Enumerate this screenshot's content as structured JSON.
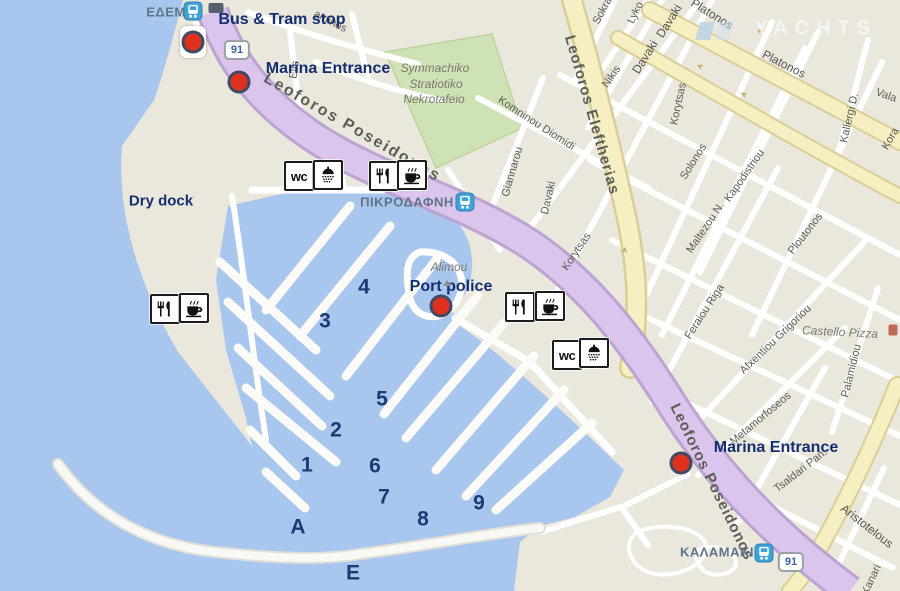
{
  "map": {
    "title": "Alimos marina map",
    "colors": {
      "water": "#A9C6EE",
      "land": "#EAE7DD",
      "green": "#CEE2B6",
      "road_purple": "#DCC5EC",
      "road_purple_edge": "#BCA3D2",
      "road_yellow": "#F5EFC2",
      "road_yellow_edge": "#DCCD96",
      "marker_red": "#E0301E",
      "label_navy": "#152F6E",
      "badge_blue": "#3B5FA8"
    },
    "watermark": {
      "text": "YACHTS"
    },
    "markers": [
      {
        "name": "bus-tram-stop",
        "label": "Bus & Tram stop",
        "label_x": 282,
        "label_y": 20,
        "dot_x": 193,
        "dot_y": 42,
        "white_bg": true
      },
      {
        "name": "marina-entrance-north",
        "label": "Marina Entrance",
        "label_x": 328,
        "label_y": 69,
        "dot_x": 239,
        "dot_y": 82,
        "white_bg": false
      },
      {
        "name": "port-police",
        "label": "Port police",
        "label_x": 451,
        "label_y": 287,
        "dot_x": 441,
        "dot_y": 306,
        "white_bg": false
      },
      {
        "name": "marina-entrance-south",
        "label": "Marina Entrance",
        "label_x": 776,
        "label_y": 448,
        "dot_x": 681,
        "dot_y": 463,
        "white_bg": false
      }
    ],
    "area_labels": [
      {
        "text": "Dry dock",
        "x": 161,
        "y": 201,
        "cls": "drydock"
      }
    ],
    "stations": [
      {
        "text": "ΕΔΕΜ",
        "x": 166,
        "y": 12,
        "icon_x": 193,
        "icon_y": 11
      },
      {
        "text": "ΠΙΚΡΟΔΑΦΝΗ",
        "x": 407,
        "y": 202,
        "icon_x": 465,
        "icon_y": 202
      },
      {
        "text": "ΚΑΛΑΜΑΚΙ",
        "x": 717,
        "y": 552,
        "icon_x": 764,
        "icon_y": 553
      }
    ],
    "route_badges": [
      {
        "text": "91",
        "x": 237,
        "y": 50
      },
      {
        "text": "91",
        "x": 791,
        "y": 562
      }
    ],
    "pier_labels": [
      {
        "text": "1",
        "x": 307,
        "y": 465
      },
      {
        "text": "2",
        "x": 336,
        "y": 430
      },
      {
        "text": "3",
        "x": 325,
        "y": 321
      },
      {
        "text": "4",
        "x": 364,
        "y": 287
      },
      {
        "text": "5",
        "x": 382,
        "y": 399
      },
      {
        "text": "6",
        "x": 375,
        "y": 466
      },
      {
        "text": "7",
        "x": 384,
        "y": 497
      },
      {
        "text": "8",
        "x": 423,
        "y": 519
      },
      {
        "text": "9",
        "x": 479,
        "y": 503
      },
      {
        "text": "A",
        "x": 298,
        "y": 527
      },
      {
        "text": "E",
        "x": 353,
        "y": 573
      }
    ],
    "street_labels": [
      {
        "text": "Leoforos Poseidonos",
        "x": 352,
        "y": 128,
        "rot": 30,
        "cls": "road"
      },
      {
        "text": "Leoforos Poseidonos",
        "x": 712,
        "y": 482,
        "rot": 64,
        "cls": "road2"
      },
      {
        "text": "Leoforos Eleftherias",
        "x": 592,
        "y": 115,
        "rot": 74,
        "cls": "road2"
      },
      {
        "text": "Platonos",
        "x": 712,
        "y": 14,
        "rot": 32,
        "cls": "street-md"
      },
      {
        "text": "Platonos",
        "x": 784,
        "y": 64,
        "rot": 27,
        "cls": "street-md"
      },
      {
        "text": "Sokra",
        "x": 603,
        "y": 11,
        "rot": -62,
        "cls": "street"
      },
      {
        "text": "Lyko",
        "x": 636,
        "y": 13,
        "rot": -64,
        "cls": "street"
      },
      {
        "text": "Davaki",
        "x": 669,
        "y": 21,
        "rot": -58,
        "cls": "street-md"
      },
      {
        "text": "Davaki",
        "x": 645,
        "y": 57,
        "rot": -58,
        "cls": "street-md"
      },
      {
        "text": "Davaki",
        "x": 549,
        "y": 198,
        "rot": -77,
        "cls": "street"
      },
      {
        "text": "Nikis",
        "x": 612,
        "y": 77,
        "rot": -55,
        "cls": "street"
      },
      {
        "text": "Giannarou",
        "x": 513,
        "y": 172,
        "rot": -74,
        "cls": "street"
      },
      {
        "text": "Komninou Diomidi",
        "x": 536,
        "y": 124,
        "rot": 33,
        "cls": "street"
      },
      {
        "text": "Korytsas",
        "x": 679,
        "y": 104,
        "rot": -78,
        "cls": "street"
      },
      {
        "text": "Korytsas",
        "x": 577,
        "y": 252,
        "rot": -56,
        "cls": "street"
      },
      {
        "text": "Solonos",
        "x": 694,
        "y": 162,
        "rot": -58,
        "cls": "street"
      },
      {
        "text": "Kapodistriou",
        "x": 745,
        "y": 176,
        "rot": -55,
        "cls": "street"
      },
      {
        "text": "Maltezou N.",
        "x": 706,
        "y": 228,
        "rot": -56,
        "cls": "street"
      },
      {
        "text": "Ploutonos",
        "x": 806,
        "y": 234,
        "rot": -52,
        "cls": "street"
      },
      {
        "text": "Kallergi D.",
        "x": 850,
        "y": 118,
        "rot": -77,
        "cls": "street"
      },
      {
        "text": "Vala",
        "x": 886,
        "y": 96,
        "rot": 20,
        "cls": "street"
      },
      {
        "text": "Kora",
        "x": 891,
        "y": 139,
        "rot": -60,
        "cls": "street"
      },
      {
        "text": "Feraiou Riga",
        "x": 705,
        "y": 312,
        "rot": -57,
        "cls": "street"
      },
      {
        "text": "Afxentiou Grigoriou",
        "x": 776,
        "y": 340,
        "rot": -44,
        "cls": "street"
      },
      {
        "text": "Metamorfoseos",
        "x": 761,
        "y": 419,
        "rot": -40,
        "cls": "street"
      },
      {
        "text": "Tsaldari Pan.",
        "x": 801,
        "y": 471,
        "rot": -38,
        "cls": "street"
      },
      {
        "text": "Palamidiou",
        "x": 852,
        "y": 371,
        "rot": -76,
        "cls": "street"
      },
      {
        "text": "Aristotelous",
        "x": 867,
        "y": 526,
        "rot": 38,
        "cls": "street-md"
      },
      {
        "text": "Kanari",
        "x": 872,
        "y": 580,
        "rot": -65,
        "cls": "street"
      },
      {
        "text": "aminos",
        "x": 330,
        "y": 22,
        "rot": 27,
        "cls": "street"
      },
      {
        "text": "Elis",
        "x": 295,
        "y": 70,
        "rot": -82,
        "cls": "street"
      }
    ],
    "poi_labels": [
      {
        "text": "Symmachiko",
        "x": 435,
        "y": 68,
        "rot": 0
      },
      {
        "text": "Stratiotiko",
        "x": 436,
        "y": 84,
        "rot": 0
      },
      {
        "text": "Nekrotafeio",
        "x": 434,
        "y": 99,
        "rot": 0
      },
      {
        "text": "Alimou",
        "x": 449,
        "y": 267,
        "rot": 0
      },
      {
        "text": "Castello Pizza",
        "x": 840,
        "y": 332,
        "rot": 3
      }
    ],
    "amenities": [
      {
        "type": "wc",
        "x": 299,
        "y": 176
      },
      {
        "type": "shower",
        "x": 328,
        "y": 175
      },
      {
        "type": "restaurant",
        "x": 384,
        "y": 176
      },
      {
        "type": "coffee",
        "x": 412,
        "y": 175
      },
      {
        "type": "restaurant",
        "x": 165,
        "y": 309
      },
      {
        "type": "coffee",
        "x": 194,
        "y": 308
      },
      {
        "type": "restaurant",
        "x": 520,
        "y": 307
      },
      {
        "type": "coffee",
        "x": 550,
        "y": 306
      },
      {
        "type": "wc",
        "x": 567,
        "y": 355
      },
      {
        "type": "shower",
        "x": 594,
        "y": 353
      }
    ],
    "road_arrows": [
      {
        "x": 700,
        "y": 66,
        "rot": 205
      },
      {
        "x": 760,
        "y": 31,
        "rot": 205
      },
      {
        "x": 744,
        "y": 94,
        "rot": 205
      },
      {
        "x": 625,
        "y": 250,
        "rot": -85
      }
    ]
  }
}
